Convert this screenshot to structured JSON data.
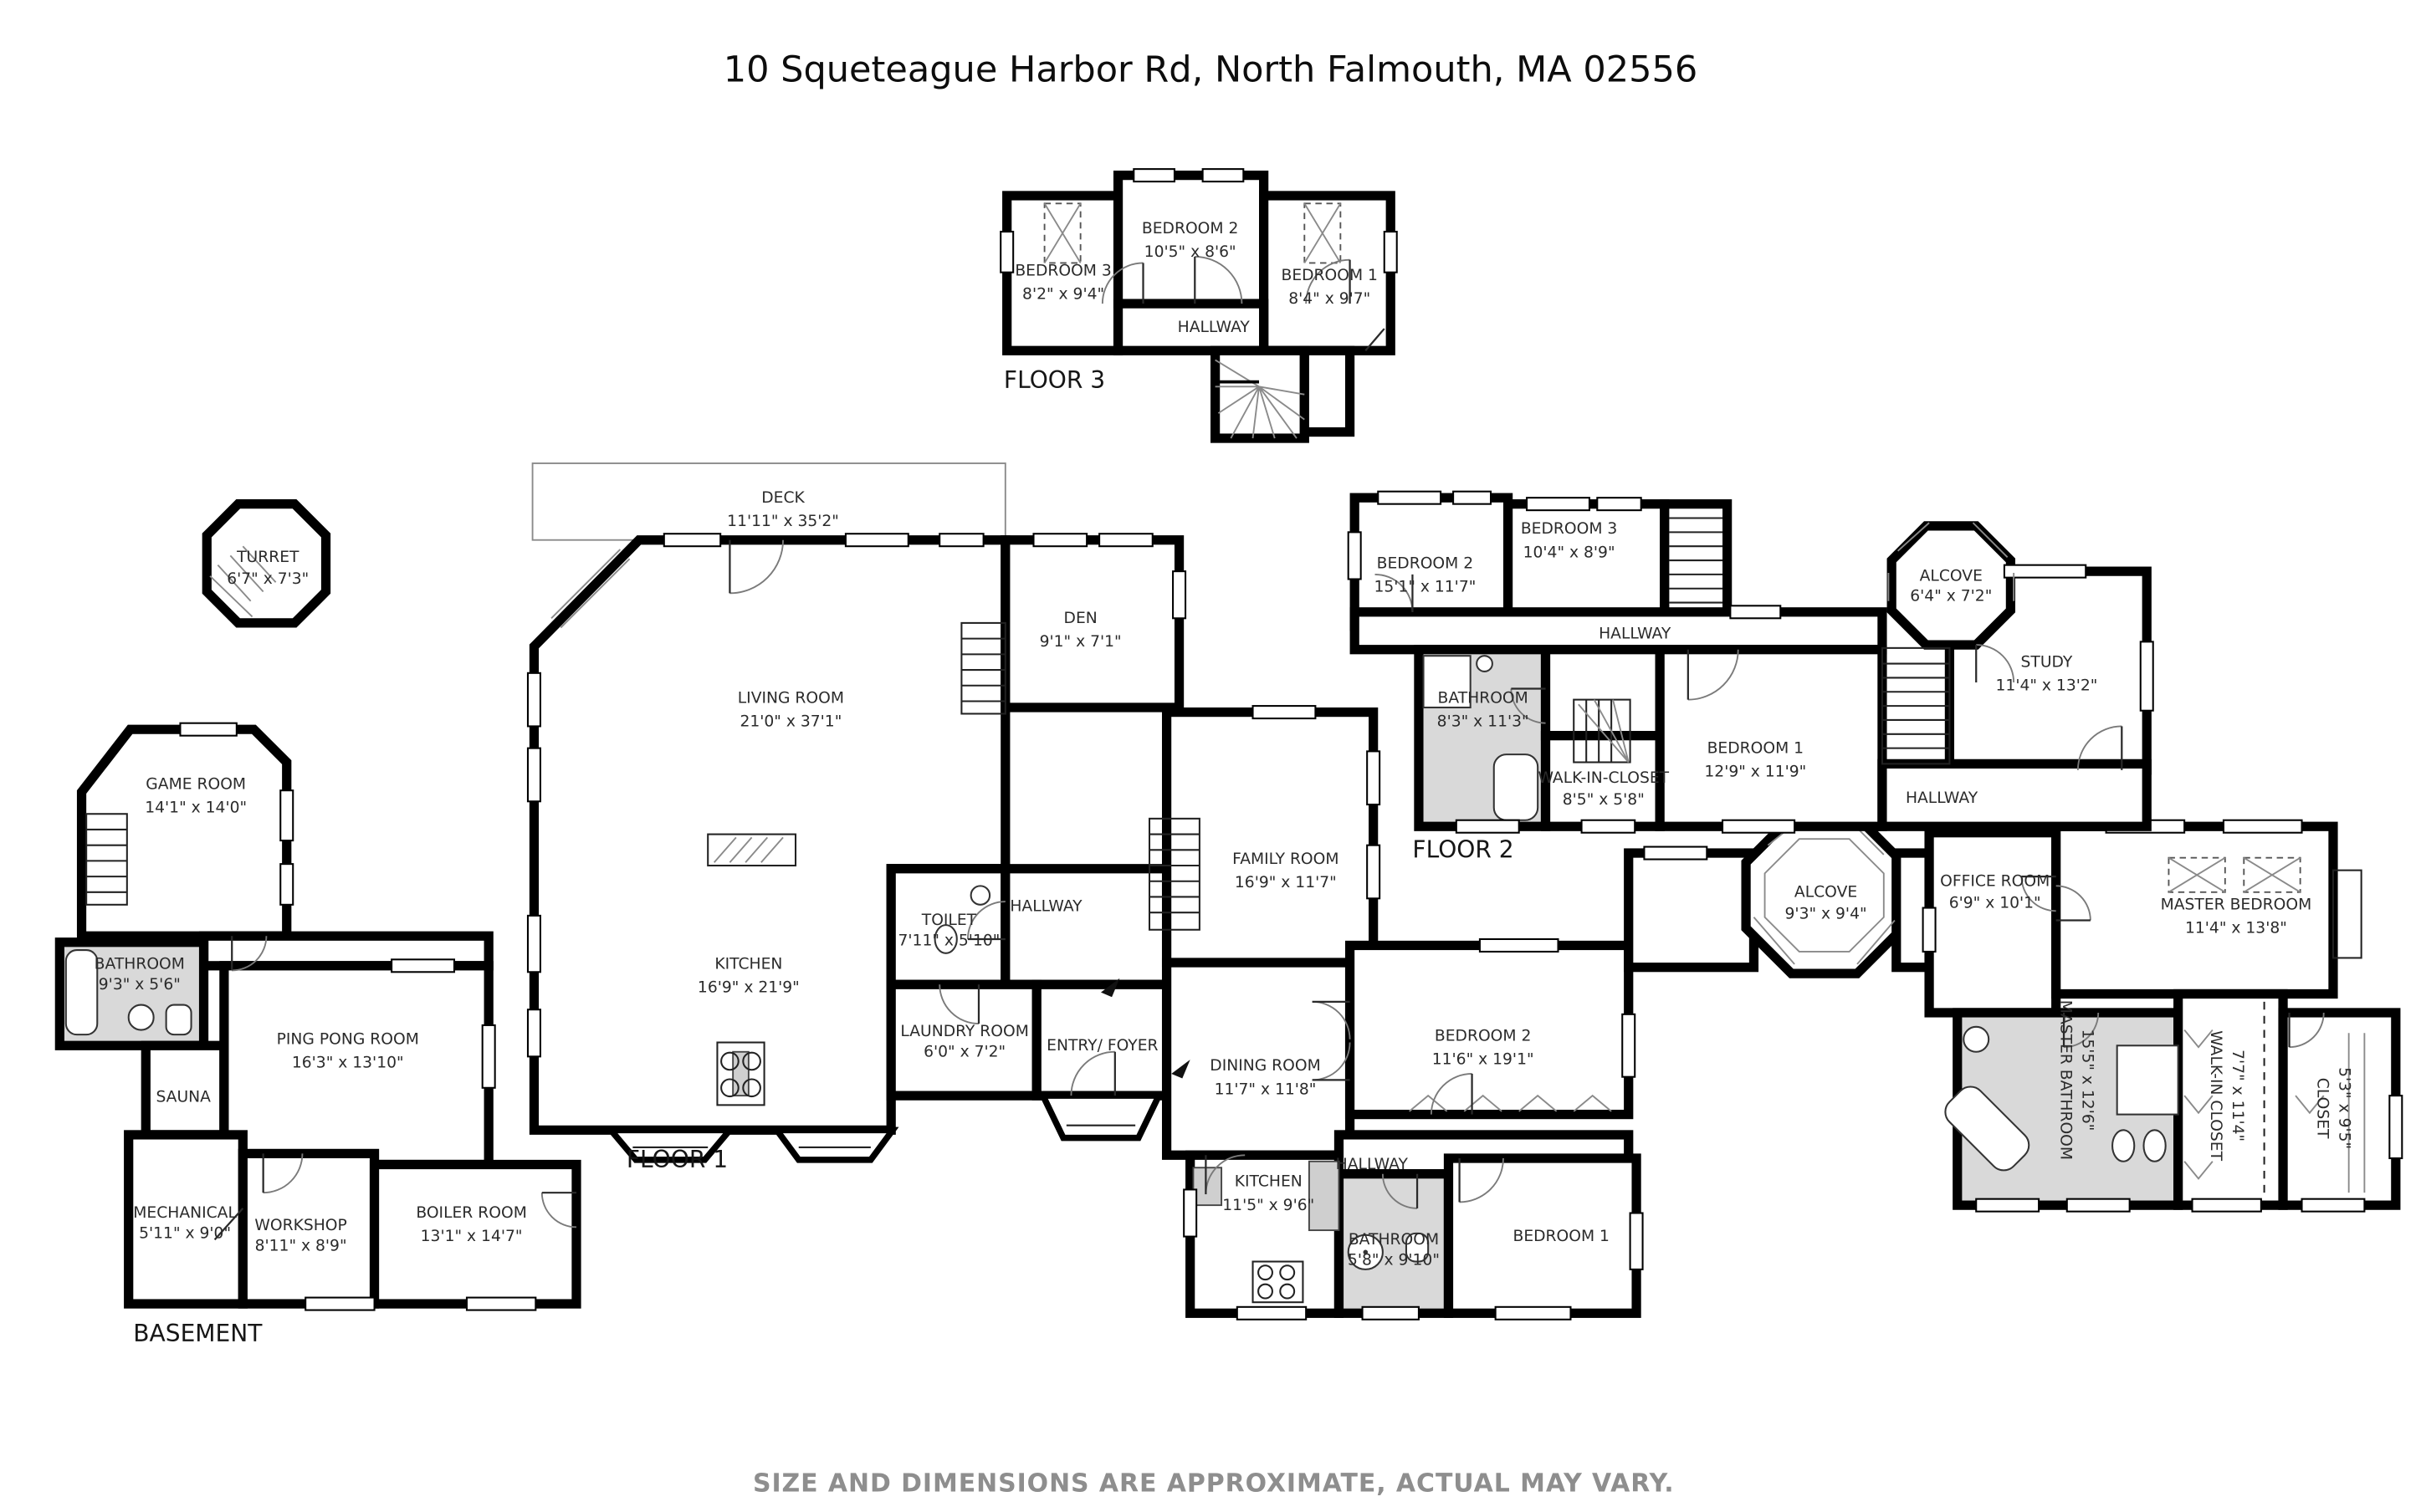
{
  "title": "10 Squeteague Harbor Rd, North Falmouth, MA 02556",
  "footer": "SIZE AND DIMENSIONS ARE APPROXIMATE, ACTUAL MAY VARY.",
  "colors": {
    "wall": "#000000",
    "bathroom_fill": "#d9d9d9",
    "label": "#2b2b2b",
    "footer": "#8e8e8e",
    "background": "#ffffff"
  },
  "floors": {
    "floor3": {
      "label": "FLOOR 3",
      "rooms": {
        "bedroom3": {
          "name": "BEDROOM 3",
          "dims": "8'2\" x 9'4\""
        },
        "bedroom2": {
          "name": "BEDROOM 2",
          "dims": "10'5\" x 8'6\""
        },
        "bedroom1": {
          "name": "BEDROOM 1",
          "dims": "8'4\" x 9'7\""
        },
        "hallway": {
          "name": "HALLWAY"
        }
      }
    },
    "floor2": {
      "label": "FLOOR 2",
      "rooms": {
        "bedroom2": {
          "name": "BEDROOM 2",
          "dims": "15'1\" x 11'7\""
        },
        "bedroom3": {
          "name": "BEDROOM 3",
          "dims": "10'4\" x 8'9\""
        },
        "hallway": {
          "name": "HALLWAY"
        },
        "bathroom": {
          "name": "BATHROOM",
          "dims": "8'3\" x 11'3\""
        },
        "walk_in_closet": {
          "name": "WALK-IN-CLOSET",
          "dims": "8'5\" x 5'8\""
        },
        "bedroom1": {
          "name": "BEDROOM 1",
          "dims": "12'9\" x 11'9\""
        },
        "alcove": {
          "name": "ALCOVE",
          "dims": "6'4\" x 7'2\""
        },
        "study": {
          "name": "STUDY",
          "dims": "11'4\" x 13'2\""
        },
        "hallway2": {
          "name": "HALLWAY"
        }
      }
    },
    "floor1": {
      "label": "FLOOR 1",
      "rooms": {
        "turret": {
          "name": "TURRET",
          "dims": "6'7\" x 7'3\""
        },
        "deck": {
          "name": "DECK",
          "dims": "11'11\" x 35'2\""
        },
        "living": {
          "name": "LIVING ROOM",
          "dims": "21'0\" x 37'1\""
        },
        "den": {
          "name": "DEN",
          "dims": "9'1\" x 7'1\""
        },
        "kitchen": {
          "name": "KITCHEN",
          "dims": "16'9\" x 21'9\""
        },
        "toilet": {
          "name": "TOILET",
          "dims": "7'11\" x 5'10\""
        },
        "hallway": {
          "name": "HALLWAY"
        },
        "laundry": {
          "name": "LAUNDRY ROOM",
          "dims": "6'0\" x 7'2\""
        },
        "entry": {
          "name": "ENTRY/ FOYER"
        },
        "family": {
          "name": "FAMILY ROOM",
          "dims": "16'9\" x 11'7\""
        },
        "dining": {
          "name": "DINING ROOM",
          "dims": "11'7\" x 11'8\""
        },
        "kitchen2": {
          "name": "KITCHEN",
          "dims": "11'5\" x 9'6\""
        },
        "hallway2": {
          "name": "HALLWAY"
        },
        "bathroom": {
          "name": "BATHROOM",
          "dims": "5'8\" x 9'10\""
        },
        "bedroom2": {
          "name": "BEDROOM 2",
          "dims": "11'6\" x 19'1\""
        },
        "bedroom1": {
          "name": "BEDROOM 1"
        },
        "alcove": {
          "name": "ALCOVE",
          "dims": "9'3\" x 9'4\""
        },
        "office": {
          "name": "OFFICE ROOM",
          "dims": "6'9\" x 10'1\""
        },
        "master_bedroom": {
          "name": "MASTER BEDROOM",
          "dims": "11'4\" x 13'8\""
        },
        "master_bathroom": {
          "name": "MASTER BATHROOM",
          "dims": "15'5\" x 12'6\""
        },
        "walk_in_closet": {
          "name": "WALK-IN CLOSET",
          "dims": "7'7\" x 11'4\""
        },
        "closet": {
          "name": "CLOSET",
          "dims": "5'3\" x 9'5\""
        }
      }
    },
    "basement": {
      "label": "BASEMENT",
      "rooms": {
        "game": {
          "name": "GAME ROOM",
          "dims": "14'1\" x 14'0\""
        },
        "bathroom": {
          "name": "BATHROOM",
          "dims": "9'3\" x 5'6\""
        },
        "sauna": {
          "name": "SAUNA"
        },
        "pingpong": {
          "name": "PING PONG ROOM",
          "dims": "16'3\" x 13'10\""
        },
        "mechanical": {
          "name": "MECHANICAL",
          "dims": "5'11\" x 9'0\""
        },
        "workshop": {
          "name": "WORKSHOP",
          "dims": "8'11\" x 8'9\""
        },
        "boiler": {
          "name": "BOILER ROOM",
          "dims": "13'1\" x 14'7\""
        }
      }
    }
  }
}
